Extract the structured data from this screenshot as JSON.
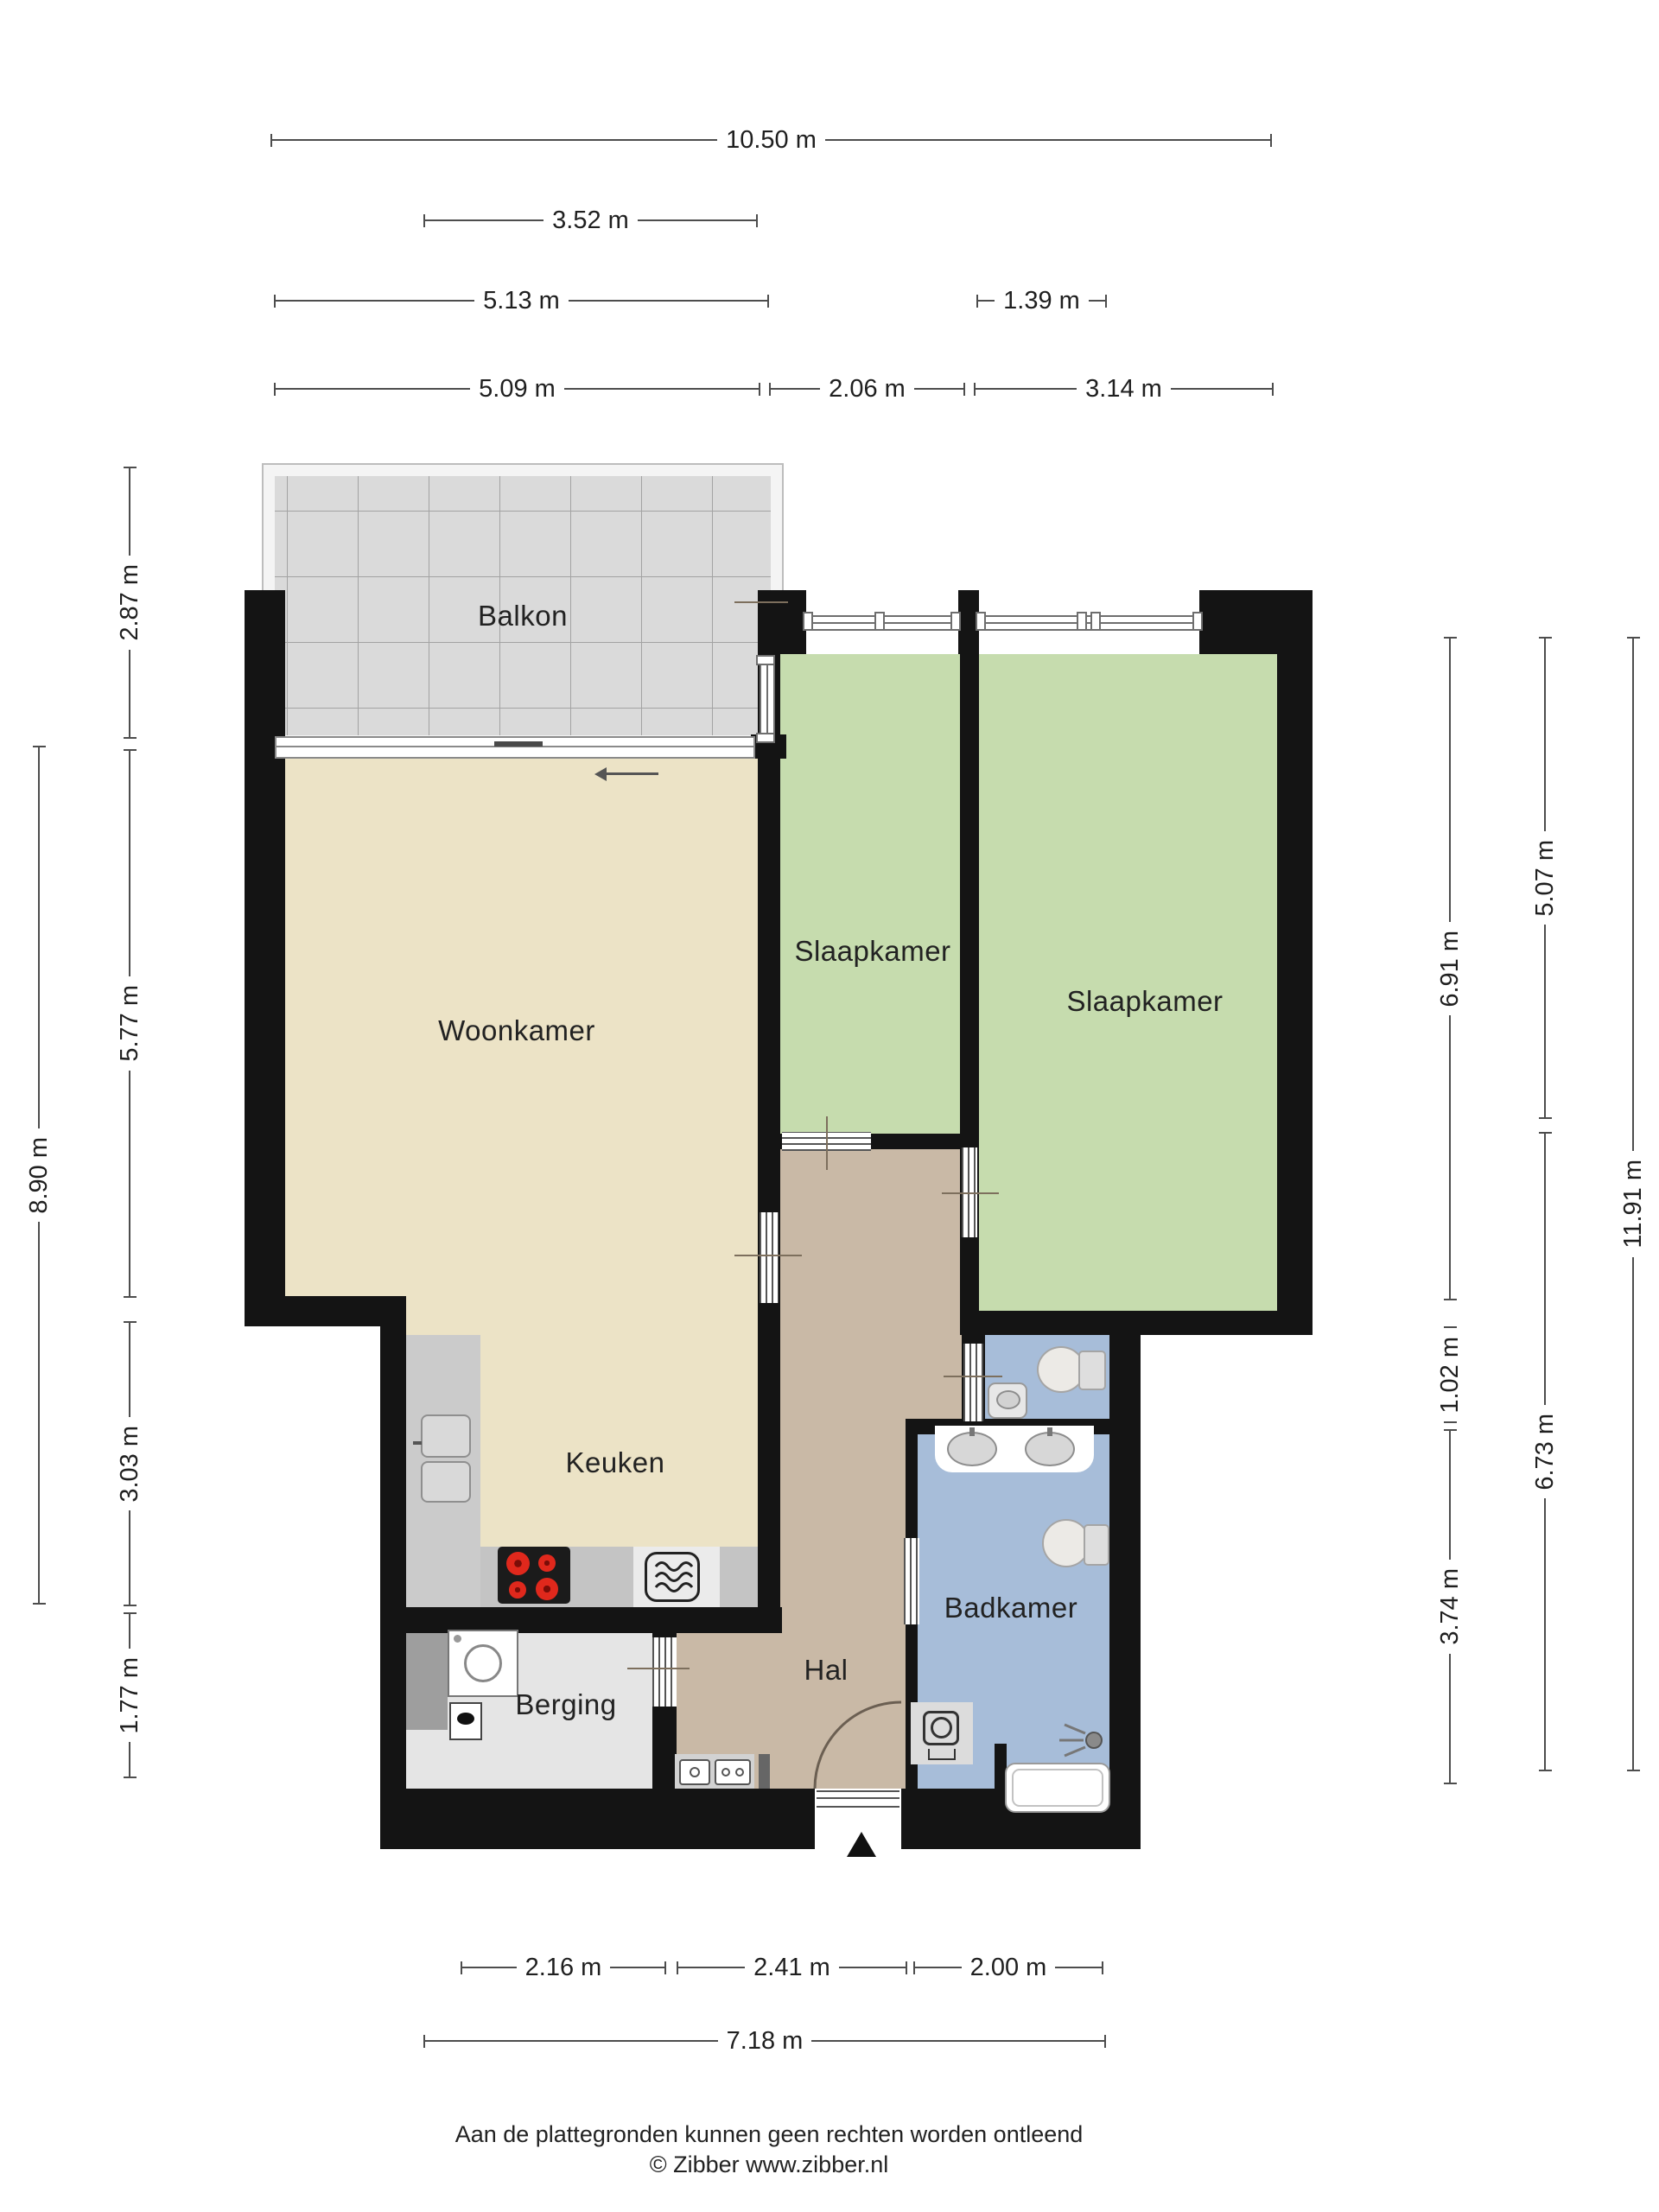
{
  "document": {
    "type": "floorplan",
    "language": "nl"
  },
  "rooms": {
    "balkon": "Balkon",
    "woonkamer": "Woonkamer",
    "slaapkamer_left": "Slaapkamer",
    "slaapkamer_right": "Slaapkamer",
    "keuken": "Keuken",
    "hal": "Hal",
    "berging": "Berging",
    "badkamer": "Badkamer"
  },
  "dimensions": {
    "top": [
      "10.50 m",
      "3.52 m",
      "5.13 m",
      "1.39 m",
      "5.09 m",
      "2.06 m",
      "3.14 m"
    ],
    "left": [
      "2.87 m",
      "5.77 m",
      "3.03 m",
      "1.77 m",
      "8.90 m"
    ],
    "right": [
      "6.91 m",
      "1.02 m",
      "3.74 m",
      "5.07 m",
      "6.73 m",
      "11.91 m"
    ],
    "bottom": [
      "2.16 m",
      "2.41 m",
      "2.00 m",
      "7.18 m"
    ]
  },
  "footer": {
    "disclaimer": "Aan de plattegronden kunnen geen rechten worden ontleend",
    "copyright": "© Zibber www.zibber.nl"
  },
  "colors": {
    "wall": "#141414",
    "living_floor": "#ece3c6",
    "bedroom_floor": "#c6dcae",
    "hall_floor": "#c9b9a6",
    "bathroom_floor": "#a7bdd9",
    "storage_floor": "#e5e5e5",
    "balcony_floor": "#dadada",
    "counter": "#c9c9c9",
    "dimension_line": "#4d4d4d",
    "burner_red": "#d8251c"
  }
}
